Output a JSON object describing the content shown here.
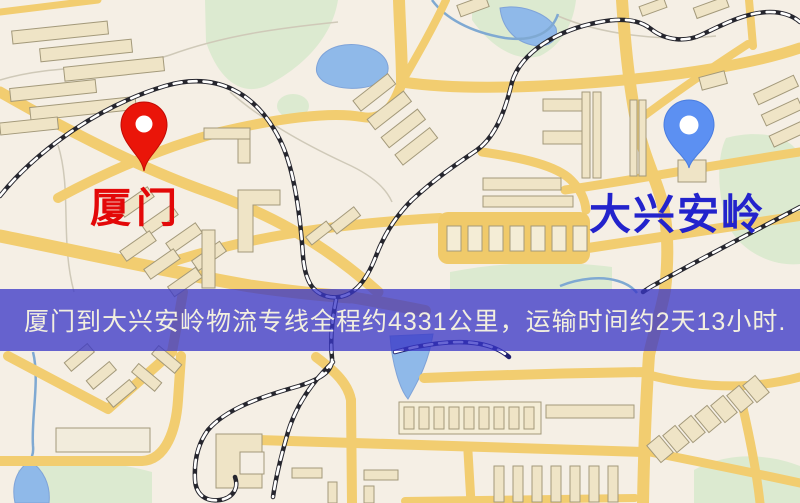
{
  "origin": {
    "label": "厦门",
    "label_color": "#e30808",
    "pin_color": "#ea1509"
  },
  "destination": {
    "label": "大兴安岭",
    "label_color": "#2323cc",
    "pin_color": "#5c90f2"
  },
  "banner": {
    "text": "厦门到大兴安岭物流专线全程约4331公里，运输时间约2天13小时.",
    "bg_color": "rgba(56,54,198,0.76)",
    "text_color": "#f2efdf"
  },
  "map_colors": {
    "land": "#f5efe5",
    "road": "#f2cd70",
    "road_loop": "#f0ca6a",
    "water": "#8fb9e9",
    "green": "#dcead0",
    "railway": "#26262e",
    "railway_water": "#20206e",
    "building_fill": "#efe4c6",
    "building_stroke": "#a3997a"
  }
}
